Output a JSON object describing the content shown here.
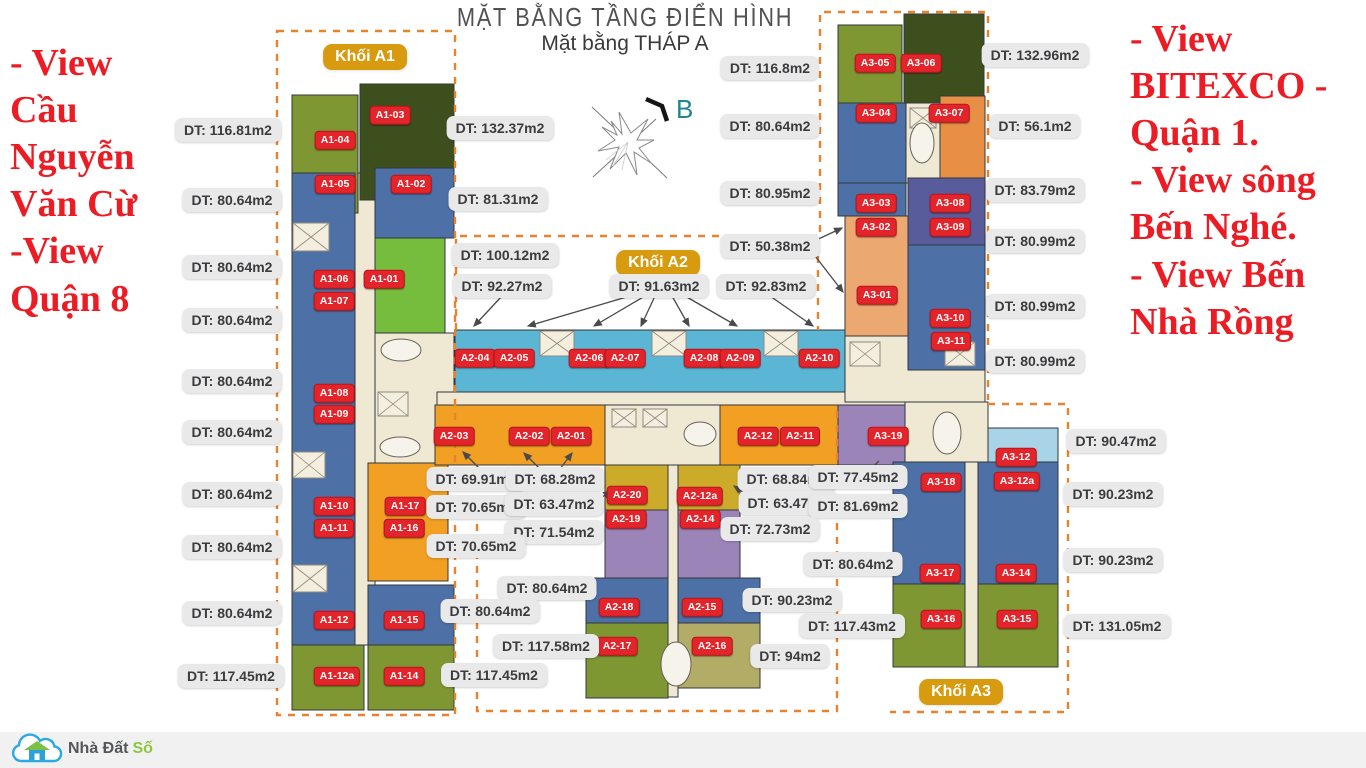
{
  "title": "MẶT BẰNG TẦNG ĐIỂN HÌNH",
  "subtitle": "Mặt bằng THÁP A",
  "compass": {
    "label": "B"
  },
  "notes": {
    "left": "- View\nCầu\nNguyễn\nVăn Cừ\n-View\nQuận 8",
    "right": "- View\nBITEXCO -\nQuận 1.\n- View sông\nBến Nghé.\n- View Bến\nNhà Rồng"
  },
  "block_labels": {
    "a1": "Khối A1",
    "a2": "Khối A2",
    "a3": "Khối A3"
  },
  "logo": {
    "text_primary": "Nhà Đất",
    "text_accent": "Số"
  },
  "colors": {
    "unit_badge": "#E3242B",
    "block_badge": "#D89B0F",
    "label_bg": "#E9E9EA",
    "dashed": "#E8822C",
    "note_red": "#EC1C24",
    "blue": "#4D71A6",
    "cyan": "#5BB5D5",
    "light_cyan": "#A9D3E6",
    "olive": "#7E9733",
    "dark_green": "#3E4F1E",
    "light_green": "#76BD3D",
    "orange": "#F2A024",
    "salmon": "#EBA871",
    "gold": "#CCAB2A",
    "purple": "#9B84B8",
    "indigo": "#585C9B",
    "khaki": "#B2AC66",
    "corridor": "#EFE8D3"
  },
  "plan": {
    "zones": [
      {
        "id": "a1-corridor",
        "x": 355,
        "y": 173,
        "w": 20,
        "h": 472,
        "c": "#EFE8D3"
      },
      {
        "id": "a1-core",
        "x": 375,
        "y": 333,
        "w": 79,
        "h": 130,
        "c": "#EFE8D3"
      },
      {
        "id": "a2-corridor",
        "x": 437,
        "y": 392,
        "w": 468,
        "h": 13,
        "c": "#EFE8D3"
      },
      {
        "id": "a2-core",
        "x": 605,
        "y": 405,
        "w": 115,
        "h": 60,
        "c": "#EFE8D3"
      },
      {
        "id": "a2-mid-corridor",
        "x": 668,
        "y": 465,
        "w": 10,
        "h": 232,
        "c": "#EFE8D3"
      },
      {
        "id": "a3-core-top",
        "x": 906,
        "y": 103,
        "w": 34,
        "h": 80,
        "c": "#EFE8D3"
      },
      {
        "id": "a3-core-mid",
        "x": 845,
        "y": 336,
        "w": 140,
        "h": 66,
        "c": "#EFE8D3"
      },
      {
        "id": "a3-core-low",
        "x": 905,
        "y": 402,
        "w": 83,
        "h": 62,
        "c": "#EFE8D3"
      },
      {
        "id": "a3-corridor",
        "x": 965,
        "y": 462,
        "w": 13,
        "h": 205,
        "c": "#EFE8D3"
      },
      {
        "id": "a1-04",
        "x": 292,
        "y": 95,
        "w": 66,
        "h": 118,
        "c": "#7E9733"
      },
      {
        "id": "a1-03",
        "x": 360,
        "y": 84,
        "w": 94,
        "h": 116,
        "c": "#3E4F1E"
      },
      {
        "id": "a1-05-12",
        "x": 292,
        "y": 173,
        "w": 63,
        "h": 472,
        "c": "#4D71A6"
      },
      {
        "id": "a1-02",
        "x": 375,
        "y": 168,
        "w": 79,
        "h": 70,
        "c": "#4D71A6"
      },
      {
        "id": "a1-01",
        "x": 375,
        "y": 238,
        "w": 70,
        "h": 95,
        "c": "#76BD3D"
      },
      {
        "id": "a1-17-16",
        "x": 368,
        "y": 463,
        "w": 80,
        "h": 118,
        "c": "#F2A024"
      },
      {
        "id": "a1-15",
        "x": 368,
        "y": 585,
        "w": 86,
        "h": 60,
        "c": "#4D71A6"
      },
      {
        "id": "a1-14",
        "x": 368,
        "y": 645,
        "w": 86,
        "h": 65,
        "c": "#7E9733"
      },
      {
        "id": "a1-12a",
        "x": 292,
        "y": 645,
        "w": 72,
        "h": 65,
        "c": "#7E9733"
      },
      {
        "id": "a2-top-row",
        "x": 455,
        "y": 330,
        "w": 390,
        "h": 62,
        "c": "#5BB5D5"
      },
      {
        "id": "a2-notch-1",
        "x": 540,
        "y": 330,
        "w": 34,
        "h": 26,
        "c": "#EFE8D3"
      },
      {
        "id": "a2-notch-2",
        "x": 652,
        "y": 330,
        "w": 34,
        "h": 26,
        "c": "#EFE8D3"
      },
      {
        "id": "a2-notch-3",
        "x": 764,
        "y": 330,
        "w": 34,
        "h": 26,
        "c": "#EFE8D3"
      },
      {
        "id": "a2-01-03",
        "x": 435,
        "y": 405,
        "w": 170,
        "h": 60,
        "c": "#F2A024"
      },
      {
        "id": "a2-11-12",
        "x": 720,
        "y": 405,
        "w": 118,
        "h": 60,
        "c": "#F2A024"
      },
      {
        "id": "a3-19",
        "x": 838,
        "y": 405,
        "w": 67,
        "h": 60,
        "c": "#9B84B8"
      },
      {
        "id": "a2-20",
        "x": 605,
        "y": 465,
        "w": 63,
        "h": 45,
        "c": "#CCAB2A"
      },
      {
        "id": "a2-12a",
        "x": 678,
        "y": 465,
        "w": 62,
        "h": 45,
        "c": "#CCAB2A"
      },
      {
        "id": "a2-19",
        "x": 605,
        "y": 510,
        "w": 63,
        "h": 68,
        "c": "#9B84B8"
      },
      {
        "id": "a2-14",
        "x": 678,
        "y": 510,
        "w": 62,
        "h": 68,
        "c": "#9B84B8"
      },
      {
        "id": "a2-18",
        "x": 586,
        "y": 578,
        "w": 82,
        "h": 45,
        "c": "#4D71A6"
      },
      {
        "id": "a2-15",
        "x": 678,
        "y": 578,
        "w": 82,
        "h": 45,
        "c": "#4D71A6"
      },
      {
        "id": "a2-17",
        "x": 586,
        "y": 623,
        "w": 82,
        "h": 75,
        "c": "#7E9733"
      },
      {
        "id": "a2-16",
        "x": 678,
        "y": 623,
        "w": 82,
        "h": 65,
        "c": "#B2AC66"
      },
      {
        "id": "a3-05",
        "x": 838,
        "y": 25,
        "w": 64,
        "h": 78,
        "c": "#7E9733"
      },
      {
        "id": "a3-06",
        "x": 904,
        "y": 14,
        "w": 80,
        "h": 89,
        "c": "#3E4F1E"
      },
      {
        "id": "a3-04",
        "x": 838,
        "y": 103,
        "w": 68,
        "h": 80,
        "c": "#4D71A6"
      },
      {
        "id": "a3-07",
        "x": 940,
        "y": 96,
        "w": 45,
        "h": 87,
        "c": "#E78F45"
      },
      {
        "id": "a3-03",
        "x": 838,
        "y": 183,
        "w": 68,
        "h": 33,
        "c": "#4D71A6"
      },
      {
        "id": "a3-01-02",
        "x": 845,
        "y": 216,
        "w": 63,
        "h": 120,
        "c": "#EBA871"
      },
      {
        "id": "a3-08-09",
        "x": 908,
        "y": 178,
        "w": 77,
        "h": 67,
        "c": "#585C9B"
      },
      {
        "id": "a3-10-11",
        "x": 908,
        "y": 245,
        "w": 77,
        "h": 125,
        "c": "#4D71A6"
      },
      {
        "id": "a3-12",
        "x": 988,
        "y": 428,
        "w": 70,
        "h": 42,
        "c": "#A9D3E6"
      },
      {
        "id": "a3-18-17",
        "x": 893,
        "y": 462,
        "w": 72,
        "h": 122,
        "c": "#4D71A6"
      },
      {
        "id": "a3-12a-14",
        "x": 978,
        "y": 462,
        "w": 80,
        "h": 122,
        "c": "#4D71A6"
      },
      {
        "id": "a3-16",
        "x": 893,
        "y": 584,
        "w": 72,
        "h": 83,
        "c": "#7E9733"
      },
      {
        "id": "a3-15",
        "x": 978,
        "y": 584,
        "w": 80,
        "h": 83,
        "c": "#7E9733"
      }
    ],
    "unit_badges": [
      {
        "id": "A1-01",
        "x": 384,
        "y": 279
      },
      {
        "id": "A1-02",
        "x": 411,
        "y": 184
      },
      {
        "id": "A1-03",
        "x": 390,
        "y": 115
      },
      {
        "id": "A1-04",
        "x": 335,
        "y": 140
      },
      {
        "id": "A1-05",
        "x": 335,
        "y": 184
      },
      {
        "id": "A1-06",
        "x": 334,
        "y": 279
      },
      {
        "id": "A1-07",
        "x": 334,
        "y": 301
      },
      {
        "id": "A1-08",
        "x": 334,
        "y": 393
      },
      {
        "id": "A1-09",
        "x": 334,
        "y": 414
      },
      {
        "id": "A1-10",
        "x": 334,
        "y": 506
      },
      {
        "id": "A1-11",
        "x": 334,
        "y": 528
      },
      {
        "id": "A1-12",
        "x": 334,
        "y": 620
      },
      {
        "id": "A1-12a",
        "x": 337,
        "y": 676
      },
      {
        "id": "A1-14",
        "x": 404,
        "y": 676
      },
      {
        "id": "A1-15",
        "x": 404,
        "y": 620
      },
      {
        "id": "A1-16",
        "x": 404,
        "y": 528
      },
      {
        "id": "A1-17",
        "x": 405,
        "y": 506
      },
      {
        "id": "A2-01",
        "x": 571,
        "y": 436
      },
      {
        "id": "A2-02",
        "x": 529,
        "y": 436
      },
      {
        "id": "A2-03",
        "x": 454,
        "y": 436
      },
      {
        "id": "A2-04",
        "x": 475,
        "y": 358
      },
      {
        "id": "A2-05",
        "x": 514,
        "y": 358
      },
      {
        "id": "A2-06",
        "x": 589,
        "y": 358
      },
      {
        "id": "A2-07",
        "x": 625,
        "y": 358
      },
      {
        "id": "A2-08",
        "x": 704,
        "y": 358
      },
      {
        "id": "A2-09",
        "x": 740,
        "y": 358
      },
      {
        "id": "A2-10",
        "x": 819,
        "y": 358
      },
      {
        "id": "A2-11",
        "x": 800,
        "y": 436
      },
      {
        "id": "A2-12",
        "x": 758,
        "y": 436
      },
      {
        "id": "A2-12a",
        "x": 700,
        "y": 496
      },
      {
        "id": "A2-14",
        "x": 700,
        "y": 519
      },
      {
        "id": "A2-15",
        "x": 702,
        "y": 607
      },
      {
        "id": "A2-16",
        "x": 712,
        "y": 646
      },
      {
        "id": "A2-17",
        "x": 617,
        "y": 646
      },
      {
        "id": "A2-18",
        "x": 619,
        "y": 607
      },
      {
        "id": "A2-19",
        "x": 626,
        "y": 519
      },
      {
        "id": "A2-20",
        "x": 627,
        "y": 495
      },
      {
        "id": "A3-01",
        "x": 877,
        "y": 295
      },
      {
        "id": "A3-02",
        "x": 876,
        "y": 227
      },
      {
        "id": "A3-03",
        "x": 876,
        "y": 203
      },
      {
        "id": "A3-04",
        "x": 876,
        "y": 113
      },
      {
        "id": "A3-05",
        "x": 875,
        "y": 63
      },
      {
        "id": "A3-06",
        "x": 921,
        "y": 63
      },
      {
        "id": "A3-07",
        "x": 949,
        "y": 113
      },
      {
        "id": "A3-08",
        "x": 950,
        "y": 203
      },
      {
        "id": "A3-09",
        "x": 950,
        "y": 227
      },
      {
        "id": "A3-10",
        "x": 950,
        "y": 318
      },
      {
        "id": "A3-11",
        "x": 951,
        "y": 341
      },
      {
        "id": "A3-12",
        "x": 1016,
        "y": 457
      },
      {
        "id": "A3-12a",
        "x": 1017,
        "y": 481
      },
      {
        "id": "A3-14",
        "x": 1016,
        "y": 573
      },
      {
        "id": "A3-15",
        "x": 1017,
        "y": 619
      },
      {
        "id": "A3-16",
        "x": 941,
        "y": 619
      },
      {
        "id": "A3-17",
        "x": 940,
        "y": 573
      },
      {
        "id": "A3-18",
        "x": 941,
        "y": 482
      },
      {
        "id": "A3-19",
        "x": 888,
        "y": 436
      }
    ],
    "block_badges": [
      {
        "key": "a1",
        "x": 365,
        "y": 57
      },
      {
        "key": "a2",
        "x": 658,
        "y": 263
      },
      {
        "key": "a3",
        "x": 961,
        "y": 692
      }
    ]
  },
  "area_labels": [
    {
      "t": "DT: 116.81m2",
      "x": 228,
      "y": 130
    },
    {
      "t": "DT: 80.64m2",
      "x": 232,
      "y": 200
    },
    {
      "t": "DT: 80.64m2",
      "x": 232,
      "y": 267
    },
    {
      "t": "DT: 80.64m2",
      "x": 232,
      "y": 320
    },
    {
      "t": "DT: 80.64m2",
      "x": 232,
      "y": 381
    },
    {
      "t": "DT: 80.64m2",
      "x": 232,
      "y": 432
    },
    {
      "t": "DT: 80.64m2",
      "x": 232,
      "y": 494
    },
    {
      "t": "DT: 80.64m2",
      "x": 232,
      "y": 547
    },
    {
      "t": "DT: 80.64m2",
      "x": 232,
      "y": 613
    },
    {
      "t": "DT: 117.45m2",
      "x": 231,
      "y": 676
    },
    {
      "t": "DT: 132.37m2",
      "x": 500,
      "y": 128
    },
    {
      "t": "DT: 81.31m2",
      "x": 498,
      "y": 199
    },
    {
      "t": "DT: 100.12m2",
      "x": 505,
      "y": 255
    },
    {
      "t": "DT: 92.27m2",
      "x": 502,
      "y": 286
    },
    {
      "t": "DT: 91.63m2",
      "x": 659,
      "y": 286
    },
    {
      "t": "DT: 92.83m2",
      "x": 766,
      "y": 286
    },
    {
      "t": "DT: 116.8m2",
      "x": 770,
      "y": 68
    },
    {
      "t": "DT: 80.64m2",
      "x": 770,
      "y": 126
    },
    {
      "t": "DT: 80.95m2",
      "x": 770,
      "y": 193
    },
    {
      "t": "DT: 50.38m2",
      "x": 770,
      "y": 246
    },
    {
      "t": "DT: 132.96m2",
      "x": 1035,
      "y": 55
    },
    {
      "t": "DT: 56.1m2",
      "x": 1035,
      "y": 126
    },
    {
      "t": "DT: 83.79m2",
      "x": 1035,
      "y": 190
    },
    {
      "t": "DT: 80.99m2",
      "x": 1035,
      "y": 241
    },
    {
      "t": "DT: 80.99m2",
      "x": 1035,
      "y": 306
    },
    {
      "t": "DT: 80.99m2",
      "x": 1035,
      "y": 361
    },
    {
      "t": "DT: 90.47m2",
      "x": 1116,
      "y": 441
    },
    {
      "t": "DT: 90.23m2",
      "x": 1113,
      "y": 494
    },
    {
      "t": "DT: 90.23m2",
      "x": 1113,
      "y": 560
    },
    {
      "t": "DT: 131.05m2",
      "x": 1117,
      "y": 626
    },
    {
      "t": "DT: 69.91m2",
      "x": 476,
      "y": 479
    },
    {
      "t": "DT: 68.28m2",
      "x": 555,
      "y": 479
    },
    {
      "t": "DT: 70.65m2",
      "x": 476,
      "y": 507
    },
    {
      "t": "DT: 63.47m2",
      "x": 554,
      "y": 504
    },
    {
      "t": "DT: 71.54m2",
      "x": 554,
      "y": 532
    },
    {
      "t": "DT: 70.65m2",
      "x": 476,
      "y": 546
    },
    {
      "t": "DT: 68.84m2",
      "x": 787,
      "y": 479
    },
    {
      "t": "DT: 77.45m2",
      "x": 858,
      "y": 477
    },
    {
      "t": "DT: 63.47m2",
      "x": 788,
      "y": 503
    },
    {
      "t": "DT: 81.69m2",
      "x": 858,
      "y": 506
    },
    {
      "t": "DT: 72.73m2",
      "x": 770,
      "y": 529
    },
    {
      "t": "DT: 80.64m2",
      "x": 853,
      "y": 564
    },
    {
      "t": "DT: 117.43m2",
      "x": 852,
      "y": 626
    },
    {
      "t": "DT: 80.64m2",
      "x": 547,
      "y": 588
    },
    {
      "t": "DT: 80.64m2",
      "x": 490,
      "y": 611
    },
    {
      "t": "DT: 117.58m2",
      "x": 546,
      "y": 646
    },
    {
      "t": "DT: 117.45m2",
      "x": 494,
      "y": 675
    },
    {
      "t": "DT: 90.23m2",
      "x": 792,
      "y": 600
    },
    {
      "t": "DT: 94m2",
      "x": 790,
      "y": 656
    }
  ]
}
